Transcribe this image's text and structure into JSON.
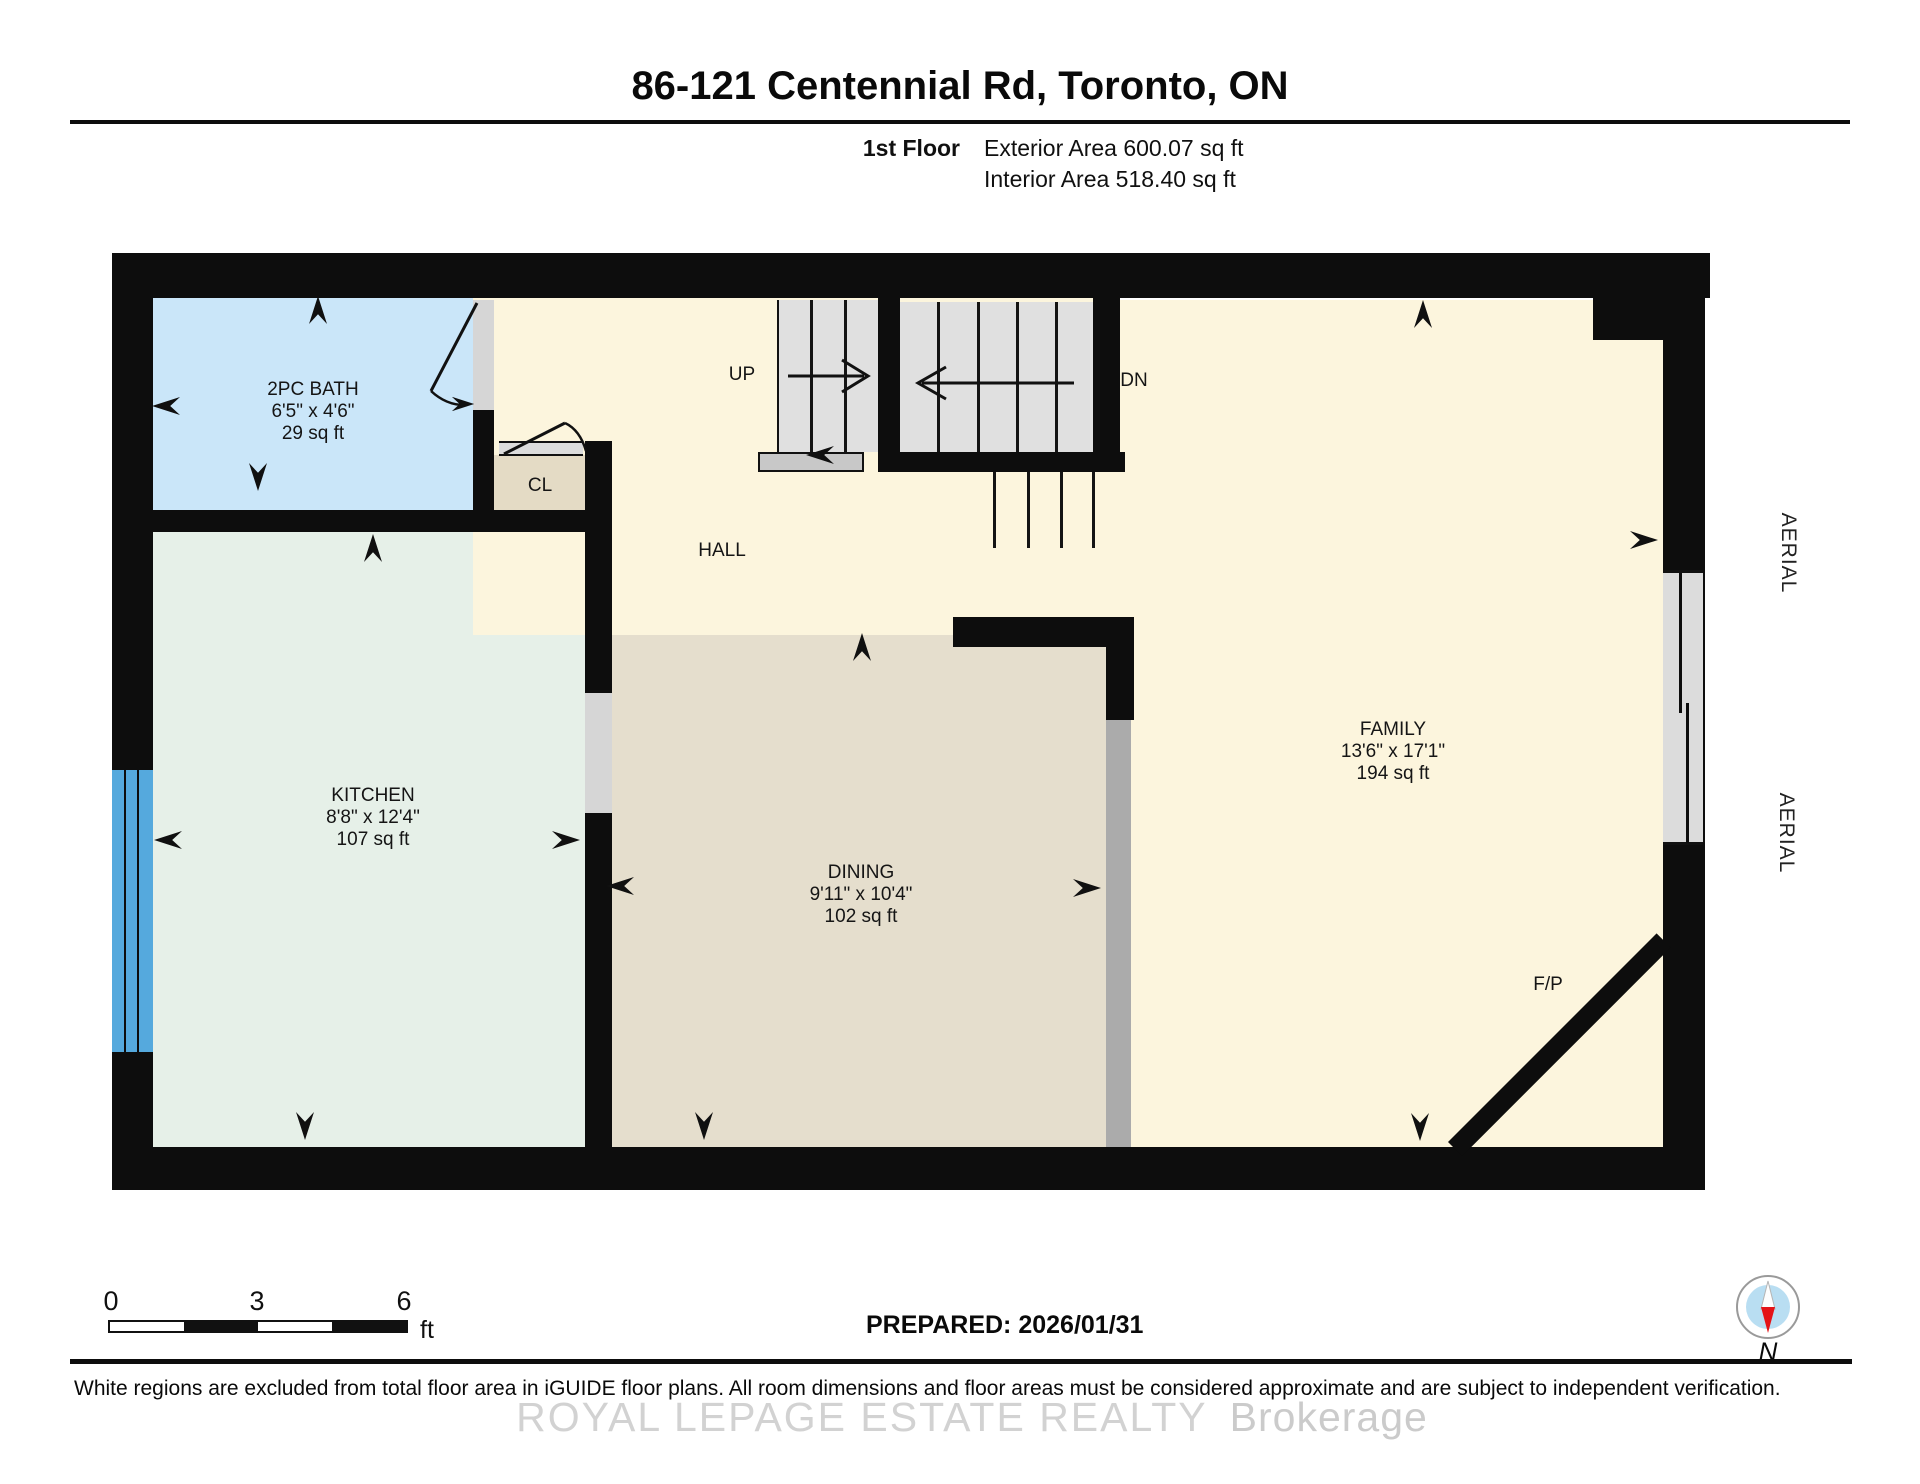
{
  "header": {
    "title": "86-121 Centennial Rd, Toronto, ON",
    "floor_label": "1st Floor",
    "exterior_area_label": "Exterior Area 600.07 sq ft",
    "interior_area_label": "Interior Area 518.40 sq ft"
  },
  "plan": {
    "rooms": [
      {
        "key": "bath",
        "name": "2PC BATH",
        "dimensions": "6'5\" x 4'6\"",
        "area": "29 sq ft",
        "fill": "#cae6f9"
      },
      {
        "key": "kitchen",
        "name": "KITCHEN",
        "dimensions": "8'8\" x 12'4\"",
        "area": "107 sq ft",
        "fill": "#e6f0e8"
      },
      {
        "key": "dining",
        "name": "DINING",
        "dimensions": "9'11\" x 10'4\"",
        "area": "102 sq ft",
        "fill": "#e5decd"
      },
      {
        "key": "family",
        "name": "FAMILY",
        "dimensions": "13'6\" x 17'1\"",
        "area": "194 sq ft",
        "fill": "#fcf5dd"
      }
    ],
    "annotations": {
      "hall": "HALL",
      "closet": "CL",
      "stairs_up": "UP",
      "stairs_down": "DN",
      "fireplace": "F/P",
      "aerial": "AERIAL"
    },
    "wall_color": "#0d0d0d",
    "window_color": "#55a9dd",
    "stair_color": "#e0e0e0"
  },
  "scale_bar": {
    "ticks": [
      "0",
      "3",
      "6"
    ],
    "unit": "ft"
  },
  "compass": {
    "north_label": "N",
    "needle_color": "#e41317",
    "dial_color": "#b9def2"
  },
  "footer": {
    "prepared_label": "PREPARED: 2026/01/31",
    "disclaimer": "White regions are excluded from total floor area in iGUIDE floor plans. All room dimensions and floor areas must be considered approximate and are subject to independent verification.",
    "watermark_primary": "ROYAL LEPAGE ESTATE REALTY",
    "watermark_secondary": "Brokerage"
  }
}
